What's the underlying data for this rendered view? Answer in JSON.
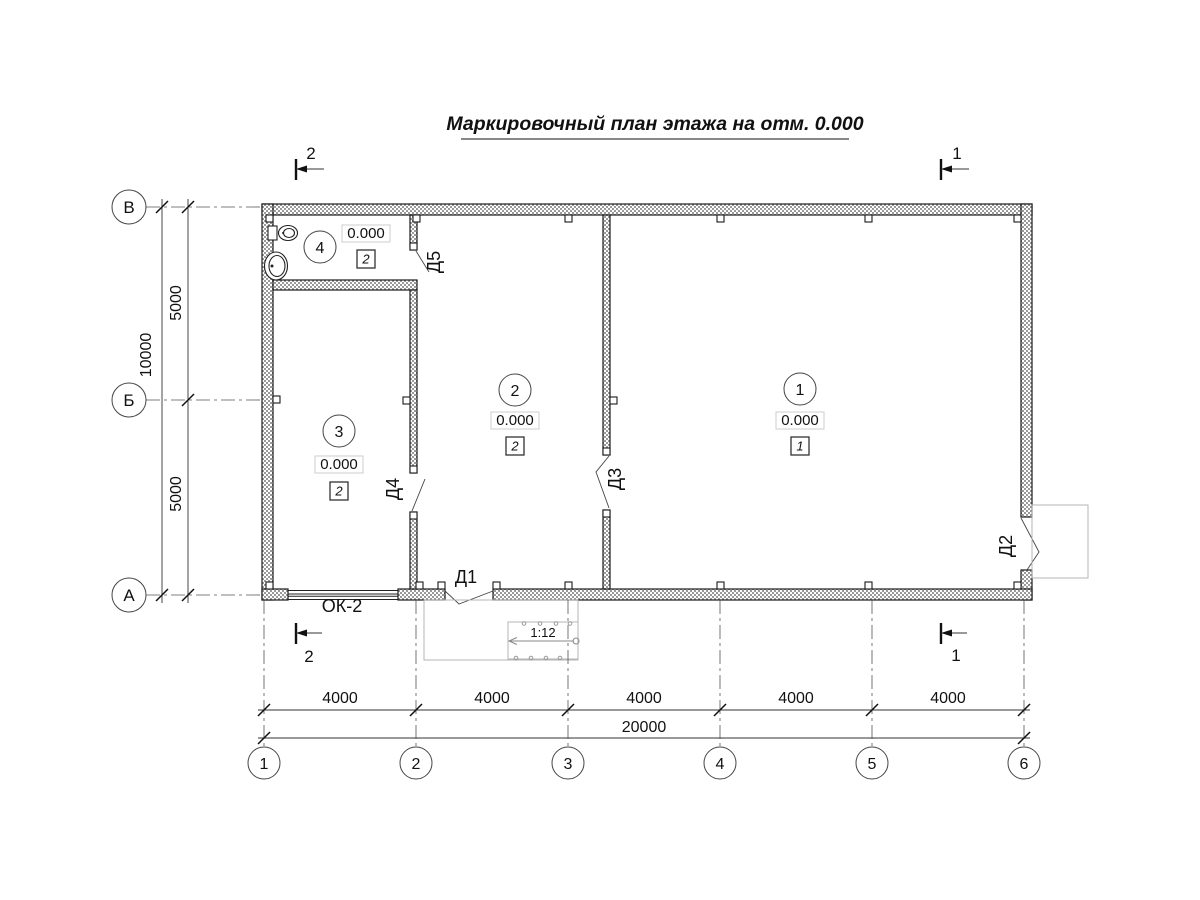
{
  "title": "Маркировочный план этажа на отм. 0.000",
  "axes": {
    "rows": [
      "В",
      "Б",
      "А"
    ],
    "cols": [
      "1",
      "2",
      "3",
      "4",
      "5",
      "6"
    ]
  },
  "dimensions": {
    "left_total": "10000",
    "left_segments": [
      "5000",
      "5000"
    ],
    "bottom_segments": [
      "4000",
      "4000",
      "4000",
      "4000",
      "4000"
    ],
    "bottom_total": "20000"
  },
  "rooms": [
    {
      "num": "1",
      "level": "0.000",
      "floor": "1"
    },
    {
      "num": "2",
      "level": "0.000",
      "floor": "2"
    },
    {
      "num": "3",
      "level": "0.000",
      "floor": "2"
    },
    {
      "num": "4",
      "level": "0.000",
      "floor": "2"
    }
  ],
  "doors": [
    "Д1",
    "Д2",
    "Д3",
    "Д4",
    "Д5"
  ],
  "window": "ОК-2",
  "ramp_slope": "1:12",
  "sections": {
    "left": "2",
    "right": "1"
  },
  "colors": {
    "line": "#1a1a1a",
    "hatch": "#9a9a9a",
    "porch": "#b5b5b5"
  }
}
